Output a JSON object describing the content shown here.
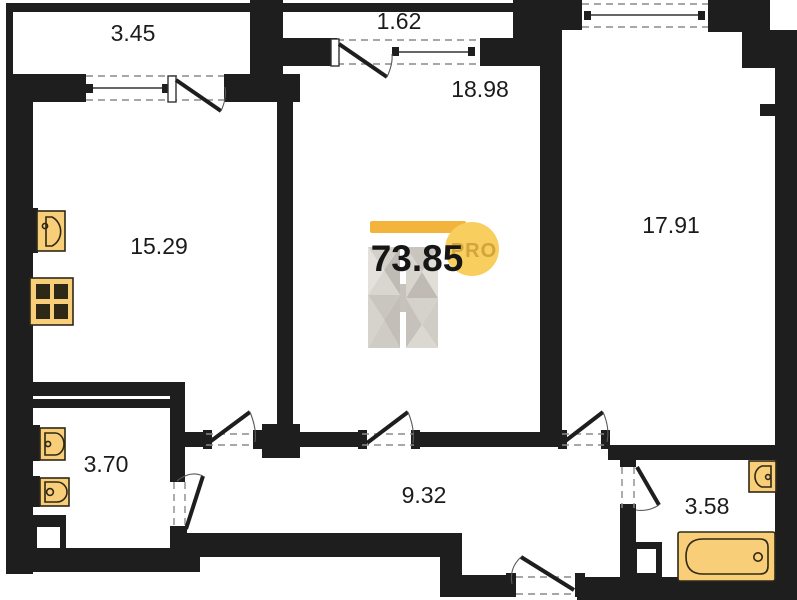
{
  "plan": {
    "total_area": "73.85",
    "watermark": {
      "pro_label": "PRO"
    },
    "rooms": [
      {
        "id": "balcony-top-left",
        "area": "3.45"
      },
      {
        "id": "balcony-top-middle",
        "area": "1.62"
      },
      {
        "id": "room-top-middle",
        "area": "18.98"
      },
      {
        "id": "room-right",
        "area": "17.91"
      },
      {
        "id": "room-left",
        "area": "15.29"
      },
      {
        "id": "bathroom-left",
        "area": "3.70"
      },
      {
        "id": "hallway",
        "area": "9.32"
      },
      {
        "id": "bathroom-right",
        "area": "3.58"
      }
    ],
    "colors": {
      "wall": "#1e1e1e",
      "fixture": "#f8ce79",
      "logo_bar": "#f2b43c",
      "logo_circle": "#f8ce5e",
      "logo_text": "#d2a43c"
    }
  }
}
